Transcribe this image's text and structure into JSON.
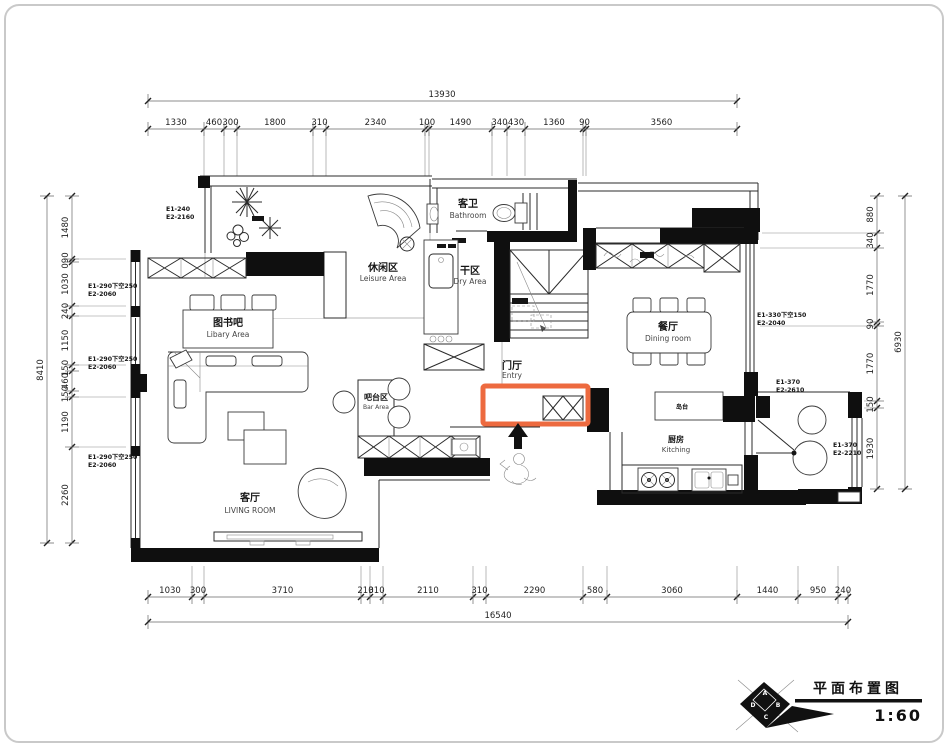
{
  "drawing": {
    "title": "平面布置图",
    "scale": "1:60",
    "logo": {
      "a": "A",
      "b": "B",
      "c": "C",
      "d": "D"
    }
  },
  "rooms": {
    "leisure": {
      "zh": "休闲区",
      "en": "Leisure Area"
    },
    "bathroom": {
      "zh": "客卫",
      "en": "Bathroom"
    },
    "dry": {
      "zh": "干区",
      "en": "Dry Area"
    },
    "dining": {
      "zh": "餐厅",
      "en": "Dining room"
    },
    "entry": {
      "zh": "门厅",
      "en": "Entry"
    },
    "bar": {
      "zh": "吧台区",
      "en": "Bar Area"
    },
    "library": {
      "zh": "图书吧",
      "en": "Libary Area"
    },
    "living": {
      "zh": "客厅",
      "en": "LIVING ROOM"
    },
    "kitchen": {
      "zh": "厨房",
      "en": "Kitching"
    },
    "island": {
      "zh": "岛台"
    }
  },
  "dimensions": {
    "top": {
      "total": "13930",
      "segments": [
        "1330",
        "460",
        "300",
        "1800",
        "310",
        "2340",
        "100",
        "1490",
        "340",
        "430",
        "1360",
        "90",
        "3560"
      ]
    },
    "bottom": {
      "total": "16540",
      "segments": [
        "1030",
        "300",
        "3710",
        "210",
        "310",
        "2110",
        "310",
        "2290",
        "580",
        "3060",
        "1440",
        "950",
        "240"
      ]
    },
    "left": {
      "total": "8410",
      "segments": [
        "1480",
        "090",
        "1030",
        "240",
        "1150",
        "150",
        "460",
        "150",
        "1190",
        "2260"
      ]
    },
    "right": {
      "total": "6930",
      "segments": [
        "880",
        "340",
        "1770",
        "90",
        "1770",
        "150",
        "1930"
      ]
    }
  },
  "window_tags": {
    "w1": {
      "l1": "E1-240",
      "l2": "E2-2160"
    },
    "w2": {
      "l1": "E1-290下空250",
      "l2": "E2-2060"
    },
    "w3": {
      "l1": "E1-290下空250",
      "l2": "E2-2060"
    },
    "w4": {
      "l1": "E1-290下空250",
      "l2": "E2-2060"
    },
    "w5": {
      "l1": "E1-330下空150",
      "l2": "E2-2040"
    },
    "w6": {
      "l1": "E1-370",
      "l2": "E2-2610"
    },
    "w7": {
      "l1": "E1-370",
      "l2": "E2-2210"
    }
  },
  "colors": {
    "highlight": "#ED6A3F",
    "wall": "#0f0f0f"
  }
}
